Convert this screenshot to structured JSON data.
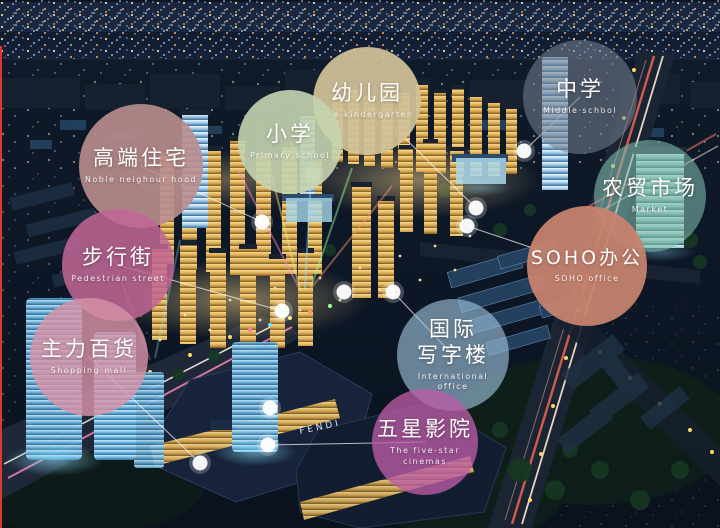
{
  "scene": {
    "mall_sign": "FENDI",
    "left_edge_line_color": "#e1382d",
    "connector_color": "#ffffff"
  },
  "callouts": [
    {
      "id": "noble-neighbourhood",
      "zh": "高端住宅",
      "en": "Noble neighour hood",
      "x": 141,
      "y": 166,
      "r": 62,
      "color": "rgba(186,142,142,0.9)",
      "line_to": {
        "x": 262,
        "y": 222
      }
    },
    {
      "id": "kindergarten",
      "zh": "幼儿园",
      "en": "The kindergarten",
      "x": 367,
      "y": 101,
      "r": 54,
      "color": "rgba(209,194,152,0.93)",
      "line_to": {
        "x": 476,
        "y": 208
      }
    },
    {
      "id": "primary-school",
      "zh": "小学",
      "en": "Primary school",
      "x": 290,
      "y": 142,
      "r": 52,
      "color": "rgba(197,212,176,0.9)",
      "line_to": {
        "x": 313,
        "y": 175
      }
    },
    {
      "id": "middle-school",
      "zh": "中学",
      "en": "Middle school",
      "x": 580,
      "y": 97,
      "r": 57,
      "color": "rgba(115,126,142,0.58)",
      "line_to": {
        "x": 524,
        "y": 151
      }
    },
    {
      "id": "market",
      "zh": "农贸市场",
      "en": "Market",
      "x": 650,
      "y": 196,
      "r": 56,
      "color": "rgba(126,188,174,0.58)",
      "line_to": null
    },
    {
      "id": "soho-office",
      "zh": "SOHO办公",
      "en": "SOHO office",
      "x": 587,
      "y": 266,
      "r": 60,
      "color": "rgba(200,131,111,0.94)",
      "line_to": {
        "x": 467,
        "y": 226
      }
    },
    {
      "id": "pedestrian-street",
      "zh": "步行街",
      "en": "Pedestrian street",
      "x": 118,
      "y": 265,
      "r": 56,
      "color": "rgba(193,102,149,0.86)",
      "line_to": {
        "x": 282,
        "y": 311
      }
    },
    {
      "id": "shopping-mall",
      "zh": "主力百货",
      "en": "Shopping mall",
      "x": 89,
      "y": 357,
      "r": 59,
      "color": "rgba(216,147,167,0.82)",
      "line_to": {
        "x": 200,
        "y": 463
      }
    },
    {
      "id": "international-office",
      "zh": "国际\n写字楼",
      "en": "International\noffice",
      "x": 453,
      "y": 355,
      "r": 56,
      "color": "rgba(162,198,224,0.62)",
      "line_to": {
        "x": 393,
        "y": 292
      }
    },
    {
      "id": "five-star-cinema",
      "zh": "五星影院",
      "en": "The five-star cinemas",
      "x": 425,
      "y": 442,
      "r": 53,
      "color": "rgba(187,92,166,0.78)",
      "line_to": {
        "x": 268,
        "y": 445
      }
    }
  ],
  "extra_dots": [
    {
      "x": 270,
      "y": 408
    },
    {
      "x": 344,
      "y": 292
    }
  ]
}
